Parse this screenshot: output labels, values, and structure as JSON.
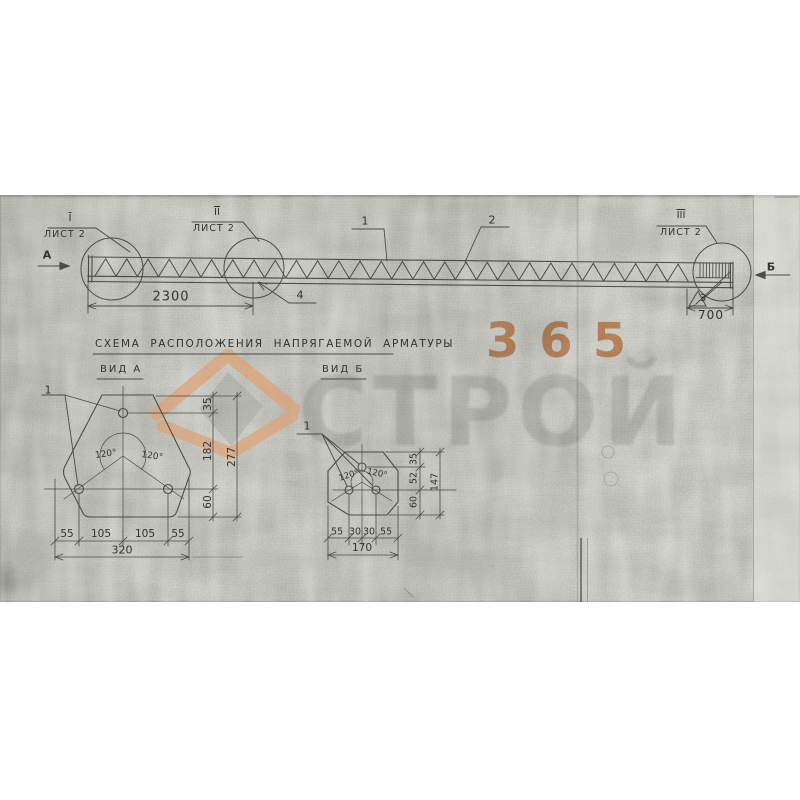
{
  "colors": {
    "paper": "#c9c9c3",
    "ink": "#3a3a33",
    "watermark_orange": "#dd8f56",
    "watermark_grey": "#82827c"
  },
  "watermark": {
    "number": "365",
    "brand": "СТРОЙ"
  },
  "title": {
    "text": "СХЕМА РАСПОЛОЖЕНИЯ НАПРЯГАЕМОЙ АРМАТУРЫ"
  },
  "views": {
    "a_label": "ВИД А",
    "b_label": "ВИД Б"
  },
  "beam": {
    "markers": [
      {
        "roman": "I",
        "sheet": "ЛИСТ 2"
      },
      {
        "roman": "II",
        "sheet": "ЛИСТ 2"
      },
      {
        "roman": "III",
        "sheet": "ЛИСТ 2"
      }
    ],
    "section_left": "А",
    "section_right": "Б",
    "callout_1": "1",
    "callout_2": "2",
    "callout_3": "3",
    "callout_4": "4",
    "dim_overall": "2300",
    "dim_end": "700"
  },
  "view_a": {
    "callout": "1",
    "angle_left": "120°",
    "angle_right": "120°",
    "dims_bottom": [
      "55",
      "105",
      "105",
      "55"
    ],
    "dim_width": "320",
    "dims_right": [
      "35",
      "182",
      "60"
    ],
    "dim_height": "277"
  },
  "view_b": {
    "callout": "1",
    "angle_left": "120°",
    "angle_right": "120°",
    "dims_bottom": [
      "55",
      "30",
      "30",
      "55"
    ],
    "dim_width": "170",
    "dims_right": [
      "35",
      "52",
      "60"
    ],
    "dim_height": "147"
  }
}
